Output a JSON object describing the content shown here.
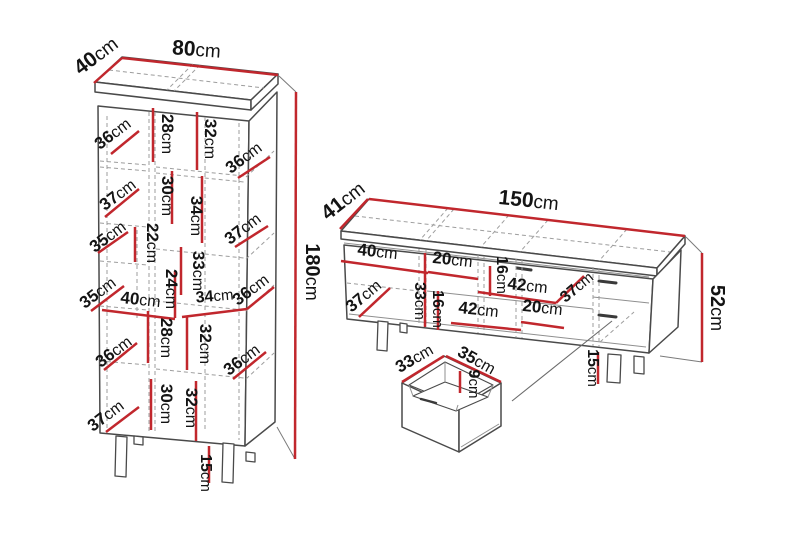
{
  "diagram_type": "furniture-dimension-diagram",
  "accent_color": "#c1272d",
  "background_color": "#ffffff",
  "cabinet": {
    "name": "tall-cabinet",
    "width": "80cm",
    "depth": "40cm",
    "height": "180cm",
    "leg_height": "15cm",
    "main_labels": [
      "40cm",
      "80cm",
      "180cm",
      "15cm"
    ],
    "interior_labels": [
      "36cm",
      "28cm",
      "32cm",
      "36cm",
      "37cm",
      "30cm",
      "34cm",
      "37cm",
      "35cm",
      "22cm",
      "33cm",
      "24cm",
      "35cm",
      "40cm",
      "34cm",
      "36cm",
      "36cm",
      "28cm",
      "32cm",
      "36cm",
      "37cm",
      "30cm",
      "32cm"
    ]
  },
  "tv_stand": {
    "name": "tv-stand",
    "width": "150cm",
    "depth": "41cm",
    "height": "52cm",
    "leg_height": "15cm",
    "main_labels": [
      "41cm",
      "150cm",
      "52cm",
      "15cm"
    ],
    "interior_labels": [
      "40cm",
      "20cm",
      "16cm",
      "42cm",
      "37cm",
      "37cm",
      "33cm",
      "16cm",
      "42cm",
      "20cm"
    ]
  },
  "drawer": {
    "name": "drawer-detail",
    "labels": [
      "33cm",
      "35cm",
      "9cm"
    ]
  }
}
